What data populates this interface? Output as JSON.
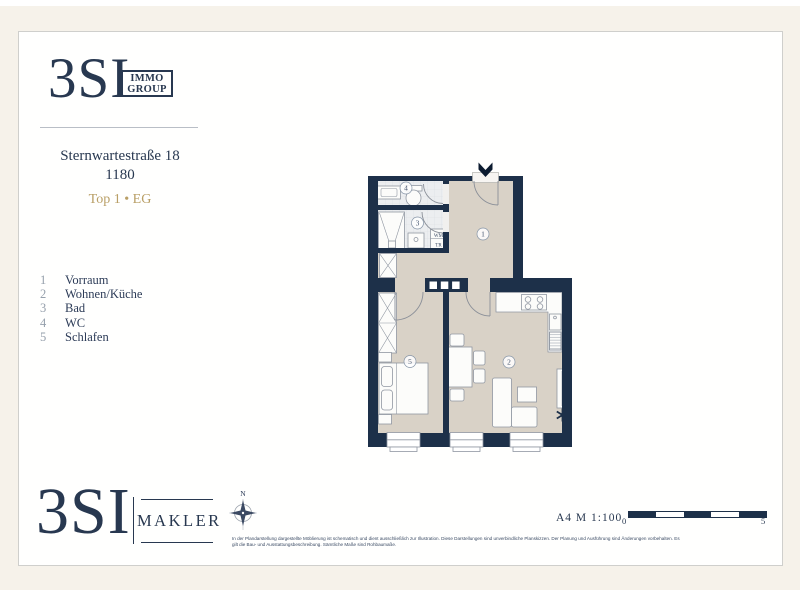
{
  "header": {
    "brand": "3SI",
    "brand_box_line1": "IMMO",
    "brand_box_line2": "GROUP",
    "address_street": "Sternwartestraße 18",
    "address_zip": "1180",
    "unit": "Top 1 • EG"
  },
  "legend": {
    "items": [
      {
        "num": "1",
        "label": "Vorraum"
      },
      {
        "num": "2",
        "label": "Wohnen/Küche"
      },
      {
        "num": "3",
        "label": "Bad"
      },
      {
        "num": "4",
        "label": "WC"
      },
      {
        "num": "5",
        "label": "Schlafen"
      }
    ]
  },
  "plan": {
    "room_numbers": {
      "vorraum": "1",
      "wohnen_kueche": "2",
      "bad": "3",
      "wc": "4",
      "schlafen": "5"
    },
    "appliances": {
      "washer": "WM",
      "dryer": "TR"
    },
    "colors": {
      "wall": "#1d3049",
      "floor": "#d9d2c7",
      "tile": "#eceef0",
      "outline": "#9097a2",
      "accent_gold": "#b99f66",
      "brand_navy": "#283850"
    }
  },
  "footer": {
    "brand": "3SI",
    "brand_sub": "MAKLER",
    "compass_north": "N",
    "disclaimer_line1": "In der Plandarstellung dargestellte Möblierung ist schematisch und dient ausschließlich zur Illustration. Diese Darstellungen sind unverbindliche Planskizzen. Der Planung und Ausführung sind Änderungen vorbehalten. Es",
    "disclaimer_line2": "gilt die Bau- und Ausstattungsbeschreibung. Sämtliche Maße sind Rohbaumaße.",
    "sheet_scale": "A4 M 1:100",
    "scalebar_start": "0",
    "scalebar_end": "5"
  }
}
